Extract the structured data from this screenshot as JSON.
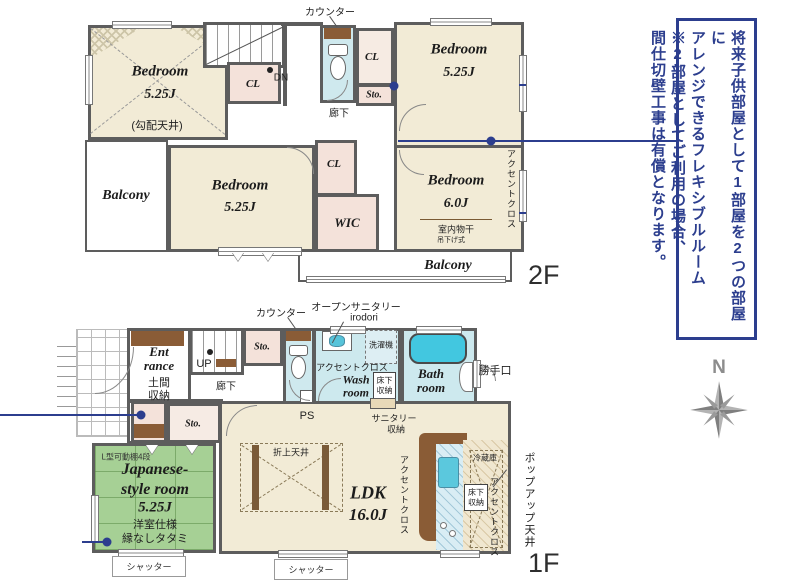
{
  "colors": {
    "wall": "#5d5d5d",
    "accent_blue": "#2c3e8e",
    "bedroom_cream": "#f2ebd6",
    "closet_pink": "#f4e2da",
    "water_aqua": "#cfe9ee",
    "tatami_green": "#a6d095",
    "counter_brown": "#8a5c36",
    "compass_gray": "#8d8d8d"
  },
  "note_box": {
    "lines": [
      "将来子供部屋として1部屋を2つの部屋に",
      "アレンジできるフレキシブルルーム",
      "※2部屋としてご利用の場合、",
      "間仕切壁工事は有償となります。"
    ]
  },
  "compass": {
    "north_label": "N"
  },
  "floor2": {
    "floor_label": "2F",
    "counter_label": "カウンター",
    "bedroom_tl": {
      "name": "Bedroom",
      "size": "5.25J",
      "ceiling_note": "(勾配天井)"
    },
    "closet_a": {
      "label": "CL"
    },
    "stairs_down_label": "DN",
    "hallway_label": "廊下",
    "closet_b": {
      "label": "CL"
    },
    "storage_b": {
      "label": "Sto."
    },
    "bedroom_tr": {
      "name": "Bedroom",
      "size": "5.25J"
    },
    "balcony_left": {
      "label": "Balcony"
    },
    "bedroom_ml": {
      "name": "Bedroom",
      "size": "5.25J"
    },
    "closet_c": {
      "label": "CL"
    },
    "wic": {
      "label": "WIC"
    },
    "bedroom_r": {
      "name": "Bedroom",
      "size": "6.0J",
      "drying_note": "室内物干",
      "drying_note2": "吊下げ式"
    },
    "accent_wall_label": "アクセントクロス",
    "balcony_bottom": {
      "label": "Balcony"
    }
  },
  "floor1": {
    "floor_label": "1F",
    "counter_label": "カウンター",
    "open_sanitary_label": "オープンサニタリー",
    "open_sanitary_sub": "irodori",
    "entrance": {
      "name_line1": "Ent",
      "name_line2": "rance",
      "storage_line1": "土間",
      "storage_line2": "収納"
    },
    "stairs_up_label": "UP",
    "storage_a": {
      "label": "Sto."
    },
    "hallway_label": "廊下",
    "washer_label": "洗濯機",
    "accent_wall_label_wash": "アクセントクロス",
    "wash_room": {
      "name_line1": "Wash",
      "name_line2": "room"
    },
    "underfloor_storage_wash": {
      "line1": "床下",
      "line2": "収納"
    },
    "bath_room": {
      "name_line1": "Bath",
      "name_line2": "room"
    },
    "back_door_label": "勝手口",
    "ps_label": "PS",
    "sanitary_storage_line1": "サニタリー",
    "sanitary_storage_line2": "収納",
    "storage_b": {
      "label": "Sto."
    },
    "shelf_note": "L型可動棚4段",
    "japanese_room": {
      "name_line1": "Japanese-",
      "name_line2": "style room",
      "size": "5.25J",
      "note1": "洋室仕様",
      "note2": "縁なしタタミ"
    },
    "coffered_ceiling_label": "折上天井",
    "ldk": {
      "name": "LDK",
      "size": "16.0J"
    },
    "accent_wall_label_kitchen": "アクセントクロス",
    "underfloor_storage_kitchen": {
      "line1": "床下",
      "line2": "収納"
    },
    "fridge_label": "冷蔵庫",
    "accent_wall_label_right": "アクセントクロス",
    "popup_ceiling_label": "ポップアップ天井",
    "shutter_left": "シャッター",
    "shutter_center": "シャッター"
  }
}
